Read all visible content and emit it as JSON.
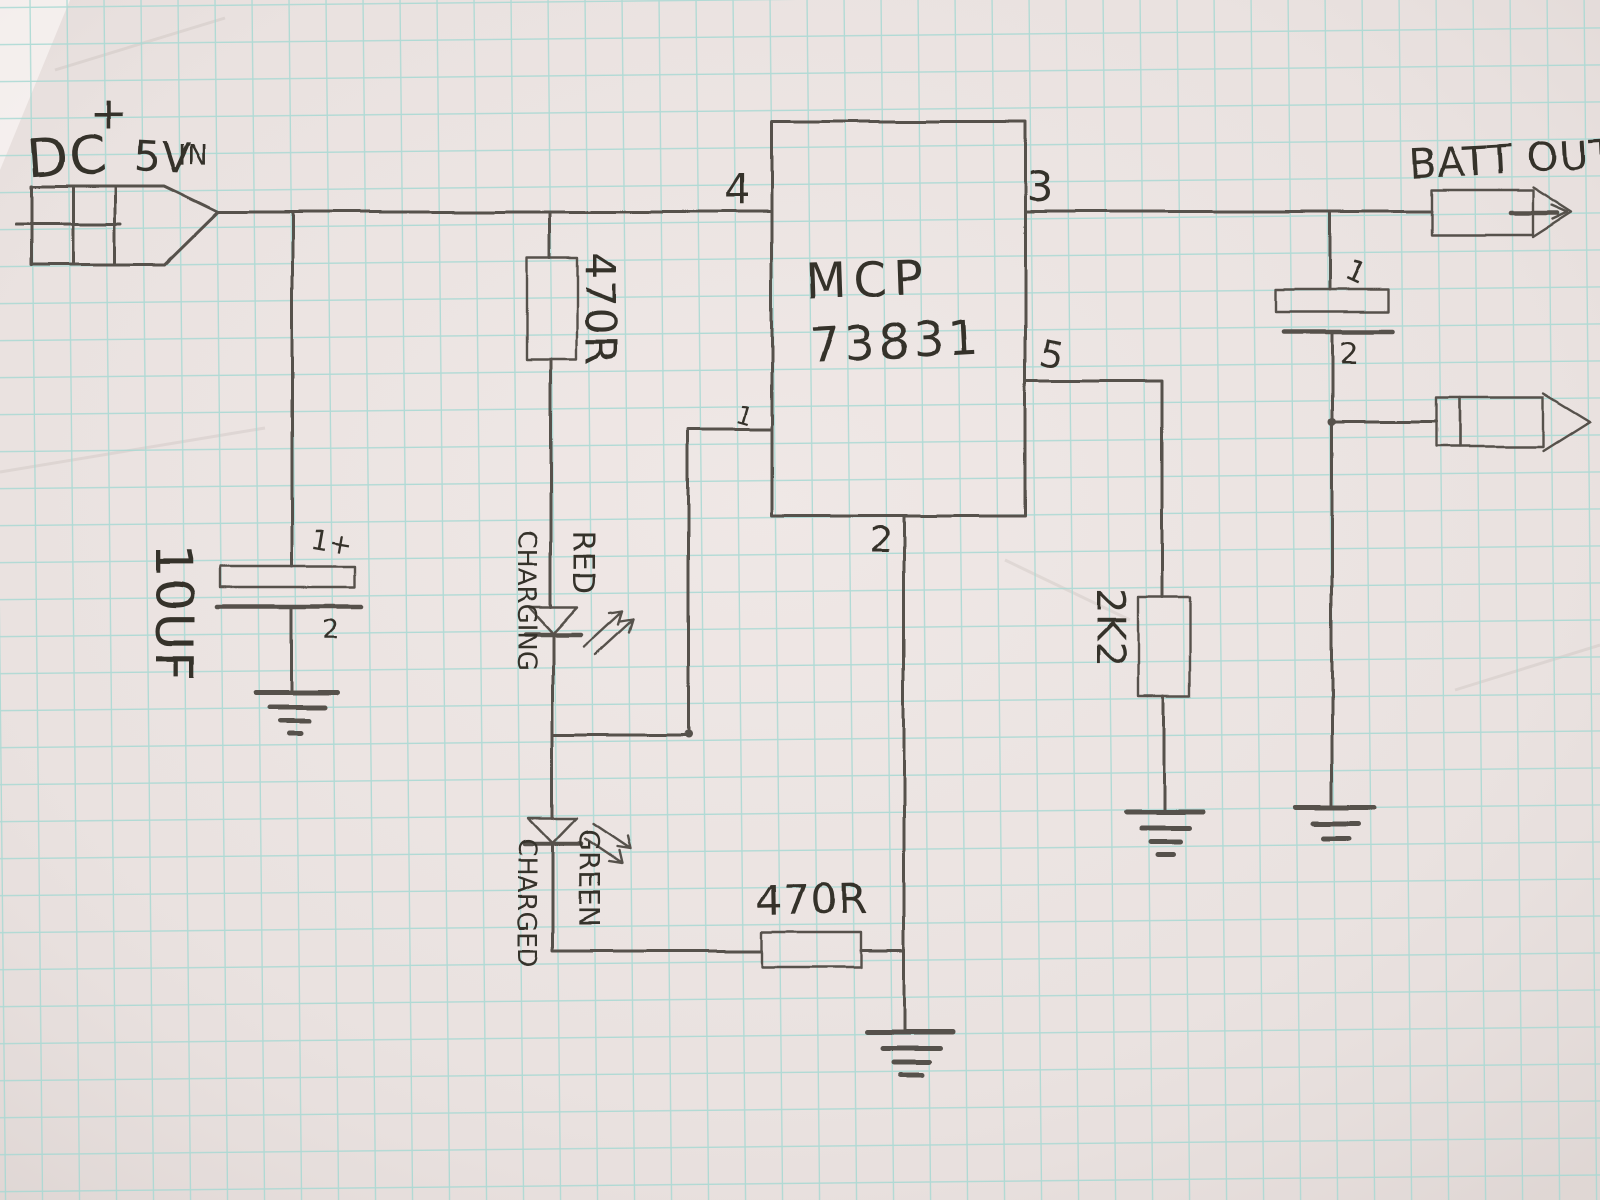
{
  "colors": {
    "paper": "#e9e1df",
    "grid_line": "#a6d8d3",
    "pencil": "#57514b",
    "ink": "#35302a"
  },
  "symbols": [
    "connector-plug",
    "polarized-capacitor",
    "resistor-box",
    "led",
    "ground",
    "ic-box"
  ],
  "power_input": {
    "label_dc": "DC",
    "label_plus": "+",
    "label_voltage": "5V",
    "label_in": "IN"
  },
  "battery_output": {
    "label": "BATT OUT"
  },
  "ic": {
    "name_line1": "MCP",
    "name_line2": "73831",
    "pin1_label": "1",
    "pin2_label": "2",
    "pin3_label": "3",
    "pin4_label": "4",
    "pin5_label": "5"
  },
  "input_capacitor": {
    "value": "10UF",
    "positive_pin": "1+",
    "negative_pin": "2"
  },
  "output_capacitor": {
    "positive_pin": "1",
    "negative_pin": "2"
  },
  "resistors": {
    "red_led_series": "470R",
    "green_led_series": "470R",
    "prog": "2K2"
  },
  "leds": {
    "red": {
      "color_label": "RED",
      "state_label": "CHARGING"
    },
    "green": {
      "color_label": "GREEN",
      "state_label": "CHARGED"
    }
  }
}
